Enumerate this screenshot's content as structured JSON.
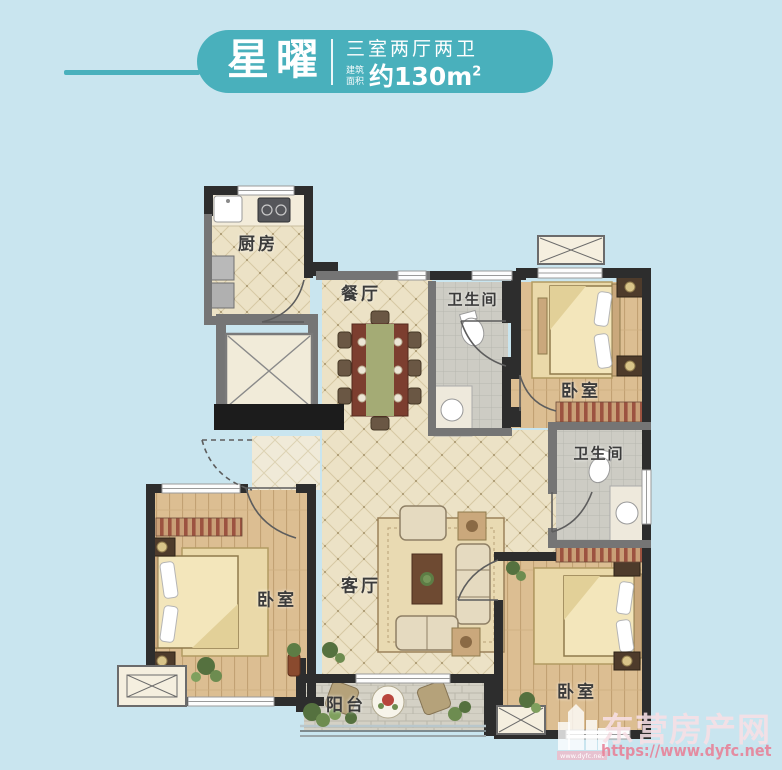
{
  "header": {
    "title": "星曜",
    "layout": "三室两厅两卫",
    "area_label_line1": "建筑",
    "area_label_line2": "面积",
    "area_value": "约130m",
    "area_sup": "2"
  },
  "floorplan": {
    "rooms": [
      {
        "id": "kitchen",
        "label": "厨房"
      },
      {
        "id": "dining",
        "label": "餐厅"
      },
      {
        "id": "bath-top",
        "label": "卫生间"
      },
      {
        "id": "bedroom-right",
        "label": "卧室"
      },
      {
        "id": "bath-middle",
        "label": "卫生间"
      },
      {
        "id": "bedroom-left",
        "label": "卧室"
      },
      {
        "id": "living",
        "label": "客厅"
      },
      {
        "id": "bedroom-bottom",
        "label": "卧室"
      },
      {
        "id": "balcony",
        "label": "阳台"
      }
    ]
  },
  "watermark": {
    "site_name": "东营房产网",
    "site_url": "https://www.dyfc.net",
    "logo_caption": "www.dyfc.net"
  },
  "colors": {
    "background": "#c9e5ef",
    "accent_teal": "#49b0bc",
    "wall_dark": "#2d2d2d",
    "wall_gray": "#757575",
    "floor_tile": "#ece2c6",
    "floor_wood": "#dcbe92",
    "floor_bath": "#cdccc4",
    "watermark_pink": "#e78096"
  }
}
